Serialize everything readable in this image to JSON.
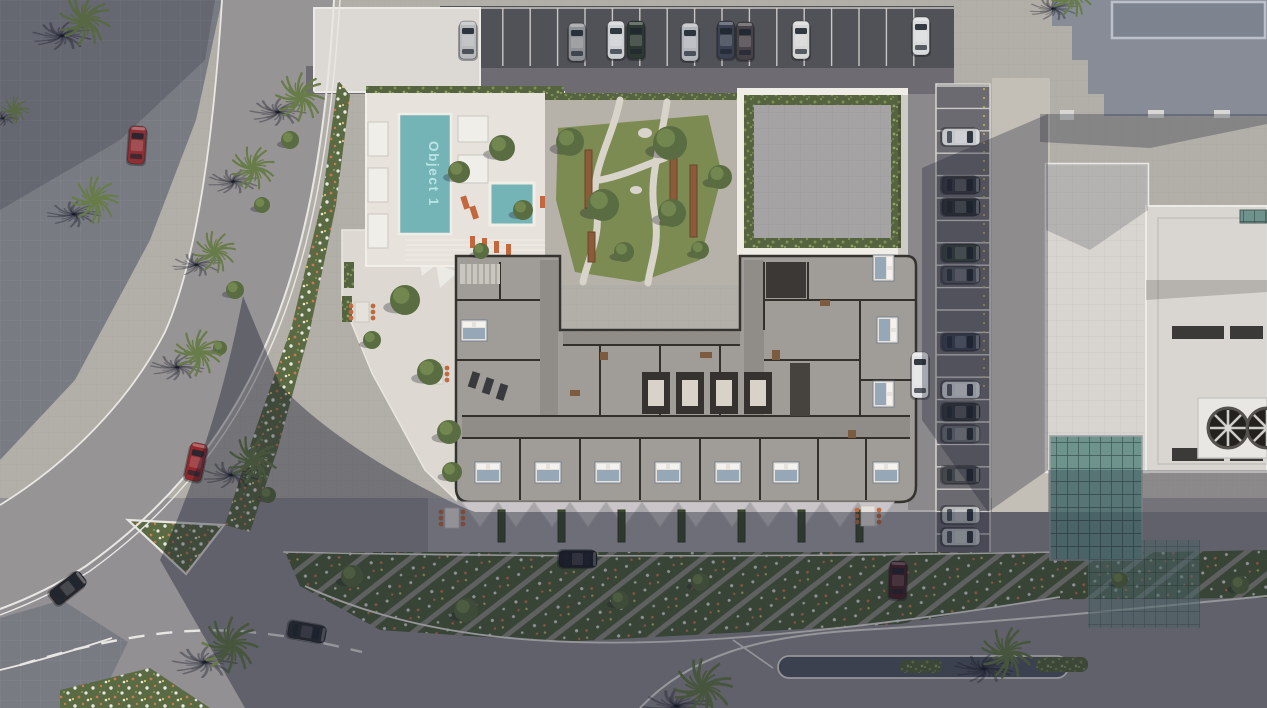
{
  "scene": {
    "type": "aerial-architectural-site-render",
    "title": "Object 1"
  },
  "pool": {
    "label": "Object 1",
    "water_color": "#74b3b6",
    "label_color": "#bfe9e9"
  },
  "palette": {
    "pavement_lit": "#b2aea8",
    "sidewalk_dark": "#797b83",
    "road": "#979495",
    "plaza_bottom": "#929093",
    "parking_asphalt": "#515257",
    "deck_white": "#e7e3dc",
    "floor": "#a09d99",
    "wall": "#33302c",
    "lawn": "#7c8b51",
    "hedge": "#55643f",
    "glass": "#6d938c",
    "shadow": "rgba(23,27,45,0.40)",
    "road_line": "#e9e7e3",
    "chair_orange": "#bf6a40",
    "bench_wood": "#8a5c3a"
  },
  "vegetation": {
    "palms": [
      [
        85,
        20,
        1.05,
        10
      ],
      [
        95,
        200,
        0.95,
        40
      ],
      [
        300,
        97,
        1.0,
        0
      ],
      [
        253,
        168,
        0.9,
        70
      ],
      [
        215,
        252,
        0.85,
        25
      ],
      [
        198,
        353,
        0.95,
        55
      ],
      [
        253,
        460,
        1.0,
        15
      ],
      [
        230,
        645,
        1.15,
        0
      ],
      [
        703,
        688,
        1.2,
        30
      ],
      [
        1007,
        653,
        1.05,
        60
      ],
      [
        1072,
        -4,
        0.85,
        20
      ],
      [
        15,
        110,
        0.55,
        45
      ]
    ],
    "bushes": [
      [
        405,
        300,
        15
      ],
      [
        372,
        340,
        9
      ],
      [
        430,
        372,
        13
      ],
      [
        449,
        432,
        12
      ],
      [
        452,
        472,
        10
      ],
      [
        459,
        172,
        11
      ],
      [
        502,
        148,
        13
      ],
      [
        523,
        210,
        10
      ],
      [
        481,
        251,
        8
      ],
      [
        570,
        142,
        14
      ],
      [
        603,
        205,
        16
      ],
      [
        670,
        143,
        17
      ],
      [
        672,
        213,
        14
      ],
      [
        720,
        177,
        12
      ],
      [
        624,
        252,
        10
      ],
      [
        700,
        250,
        9
      ],
      [
        290,
        140,
        9
      ],
      [
        262,
        205,
        8
      ],
      [
        235,
        290,
        9
      ],
      [
        220,
        348,
        7
      ],
      [
        268,
        495,
        8
      ],
      [
        352,
        576,
        11
      ],
      [
        466,
        610,
        12
      ],
      [
        620,
        600,
        9
      ],
      [
        700,
        582,
        9
      ],
      [
        1120,
        580,
        8
      ],
      [
        1240,
        585,
        9
      ]
    ]
  },
  "cars": [
    [
      468,
      40,
      0,
      "#b9babd"
    ],
    [
      577,
      42,
      0,
      "#8d9094"
    ],
    [
      616,
      40,
      0,
      "#cdd0d2"
    ],
    [
      636,
      40,
      0,
      "#2e3832"
    ],
    [
      690,
      42,
      0,
      "#b3b6bb"
    ],
    [
      726,
      40,
      0,
      "#3b4150"
    ],
    [
      745,
      41,
      0,
      "#474247"
    ],
    [
      801,
      40,
      0,
      "#d5d6d5"
    ],
    [
      921,
      36,
      0,
      "#d9dadb"
    ],
    [
      961,
      137,
      90,
      "#c6c8cb"
    ],
    [
      961,
      185,
      90,
      "#393c41"
    ],
    [
      961,
      207,
      90,
      "#2f3337"
    ],
    [
      961,
      253,
      90,
      "#394440"
    ],
    [
      961,
      275,
      90,
      "#54585e"
    ],
    [
      961,
      342,
      90,
      "#3b4251"
    ],
    [
      961,
      390,
      90,
      "#c9cbce"
    ],
    [
      961,
      412,
      90,
      "#33373c"
    ],
    [
      961,
      434,
      90,
      "#696d72"
    ],
    [
      961,
      475,
      90,
      "#44474c"
    ],
    [
      961,
      515,
      90,
      "#b5b7b9"
    ],
    [
      961,
      537,
      90,
      "#bfc1c3"
    ],
    [
      137,
      145,
      4,
      "#8e2f33"
    ],
    [
      196,
      462,
      12,
      "#93282c"
    ],
    [
      68,
      588,
      52,
      "#24262c"
    ],
    [
      307,
      632,
      100,
      "#2a2d31"
    ],
    [
      578,
      559,
      90,
      "#1e2025"
    ],
    [
      898,
      580,
      2,
      "#4b2127"
    ],
    [
      920,
      375,
      0,
      "#e3e3e5",
      46
    ]
  ],
  "parking": {
    "top": {
      "x1": 448,
      "x2": 940,
      "y": 8,
      "h": 58,
      "step": 27.4
    },
    "right": {
      "x": 936,
      "w": 54,
      "y1": 86,
      "y2": 556,
      "step": 22.4
    }
  },
  "floorplan": {
    "beds": [
      [
        488,
        472,
        0
      ],
      [
        548,
        472,
        0
      ],
      [
        608,
        472,
        0
      ],
      [
        668,
        472,
        0
      ],
      [
        728,
        472,
        0
      ],
      [
        786,
        472,
        0
      ],
      [
        886,
        472,
        0
      ],
      [
        884,
        268,
        90
      ],
      [
        888,
        330,
        90
      ],
      [
        884,
        394,
        90
      ],
      [
        474,
        330,
        0
      ]
    ],
    "elevator_xs": [
      642,
      676,
      710,
      744
    ]
  },
  "facade": {
    "planter_xs": [
      498,
      558,
      618,
      678,
      738,
      798,
      856
    ],
    "awnings": {
      "x1": 462,
      "step": 36,
      "count": 12,
      "y": 502,
      "tip": 527
    },
    "chair_groups": [
      [
        452,
        518
      ],
      [
        868,
        516
      ],
      [
        362,
        312
      ],
      [
        436,
        374
      ]
    ]
  },
  "garden": {
    "bench_list": [
      [
        585,
        150,
        58
      ],
      [
        670,
        148,
        62
      ],
      [
        690,
        165,
        72
      ],
      [
        588,
        232,
        30
      ]
    ]
  }
}
